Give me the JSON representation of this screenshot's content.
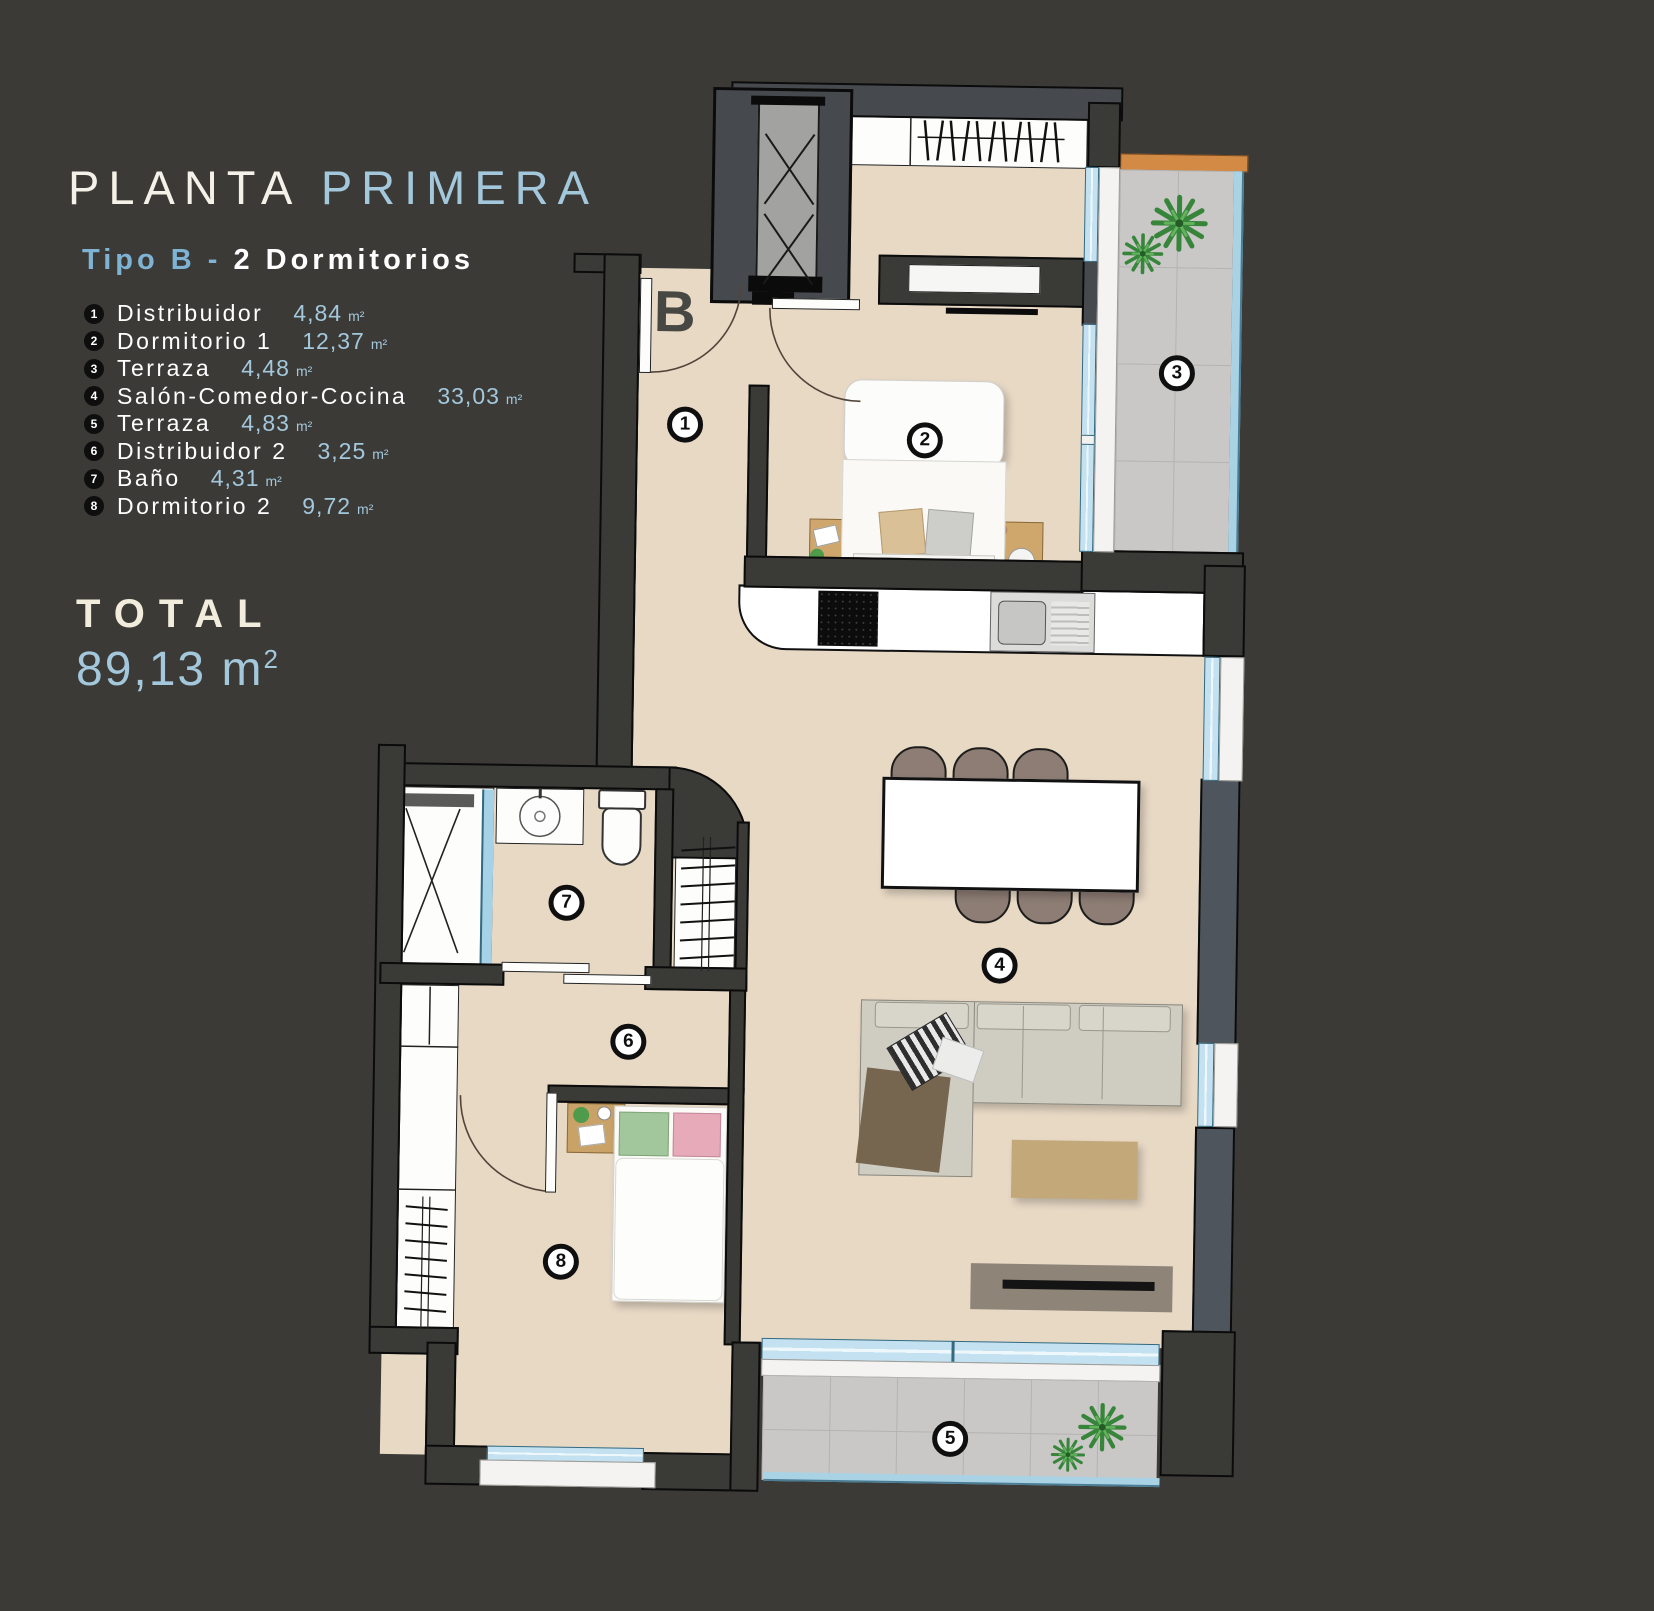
{
  "header": {
    "title_primary": "PLANTA",
    "title_secondary": "PRIMERA",
    "subtitle_accent": "Tipo B -",
    "subtitle_rest": "2 Dormitorios"
  },
  "legend": {
    "items": [
      {
        "num": "1",
        "name": "Distribuidor",
        "area": "4,84",
        "unit": "m²"
      },
      {
        "num": "2",
        "name": "Dormitorio 1",
        "area": "12,37",
        "unit": "m²"
      },
      {
        "num": "3",
        "name": "Terraza",
        "area": "4,48",
        "unit": "m²"
      },
      {
        "num": "4",
        "name": "Salón-Comedor-Cocina",
        "area": "33,03",
        "unit": "m²"
      },
      {
        "num": "5",
        "name": "Terraza",
        "area": "4,83",
        "unit": "m²"
      },
      {
        "num": "6",
        "name": "Distribuidor 2",
        "area": "3,25",
        "unit": "m²"
      },
      {
        "num": "7",
        "name": "Baño",
        "area": "4,31",
        "unit": "m²"
      },
      {
        "num": "8",
        "name": "Dormitorio 2",
        "area": "9,72",
        "unit": "m²"
      }
    ]
  },
  "total": {
    "label": "TOTAL",
    "value": "89,13",
    "unit": "m",
    "sup": "2"
  },
  "plan": {
    "block_letter": "B",
    "markers": [
      "1",
      "2",
      "3",
      "4",
      "5",
      "6",
      "7",
      "8"
    ]
  },
  "colors": {
    "accent_blue": "#a3c8dc",
    "floor_beige": "#e8d9c5",
    "wall_dark": "#3a3a36",
    "wall_slate": "#4e555d",
    "terrace_wood": "#d28a45",
    "glass_blue": "#c3e1f0"
  }
}
